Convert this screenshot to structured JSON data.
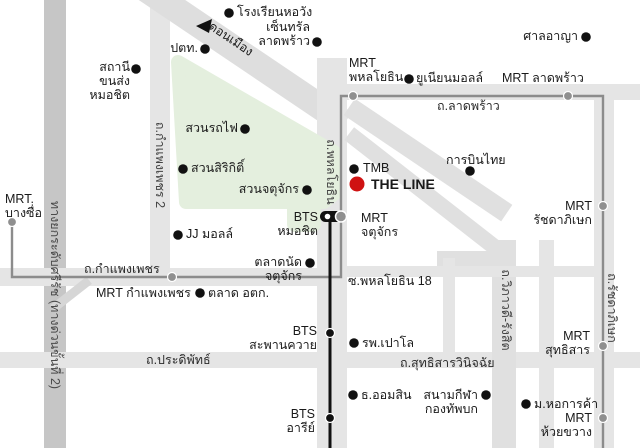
{
  "canvas": {
    "w": 640,
    "h": 448,
    "bg": "#ffffff"
  },
  "palette": {
    "road": "#e5e5e5",
    "road_diag": "#dedede",
    "expressway": "#c6c6c6",
    "park_green": "#e4efde",
    "mrt_line": "#8c8c8c",
    "mrt_station": "#8f8f8f",
    "bts_line": "#111111",
    "poi_dot": "#111111",
    "the_line_red": "#cf1212",
    "text": "#1a1a1a"
  },
  "roads": [
    {
      "name": "road-expressway-sirat",
      "x": 44,
      "y": 0,
      "w": 22,
      "h": 448,
      "rot": 0,
      "color": "#c6c6c6"
    },
    {
      "name": "road-kamphaengphet2-vertical",
      "x": 150,
      "y": 0,
      "w": 20,
      "h": 282,
      "rot": 0,
      "color": "#e5e5e5"
    },
    {
      "name": "road-donmueang-diagonal",
      "x": 125,
      "y": 43,
      "w": 240,
      "h": 26,
      "rot": 34,
      "color": "#dedede"
    },
    {
      "name": "road-phahonyothin-vertical",
      "x": 317,
      "y": 58,
      "w": 30,
      "h": 390,
      "rot": 0,
      "color": "#e5e5e5"
    },
    {
      "name": "road-ladprao-horizontal",
      "x": 332,
      "y": 84,
      "w": 308,
      "h": 16,
      "rot": 0,
      "color": "#e5e5e5"
    },
    {
      "name": "road-kamphaengphet-horizontal",
      "x": 0,
      "y": 268,
      "w": 347,
      "h": 18,
      "rot": 0,
      "color": "#e5e5e5"
    },
    {
      "name": "road-pradipat-sutthisan",
      "x": 0,
      "y": 352,
      "w": 640,
      "h": 16,
      "rot": 0,
      "color": "#e5e5e5"
    },
    {
      "name": "road-vibhavadi-diagonal-a",
      "x": 333,
      "y": 150,
      "w": 190,
      "h": 20,
      "rot": 34,
      "color": "#e0e0e0"
    },
    {
      "name": "road-vibhavadi-diagonal-b",
      "x": 329,
      "y": 184,
      "w": 190,
      "h": 16,
      "rot": 38,
      "color": "#e0e0e0"
    },
    {
      "name": "road-vibhavadi-vertical",
      "x": 492,
      "y": 240,
      "w": 24,
      "h": 208,
      "rot": 0,
      "color": "#e0e0e0"
    },
    {
      "name": "road-vibhavadi-connector",
      "x": 437,
      "y": 251,
      "w": 70,
      "h": 15,
      "rot": 0,
      "color": "#e0e0e0"
    },
    {
      "name": "road-soi-phahonyothin18",
      "x": 347,
      "y": 266,
      "w": 250,
      "h": 11,
      "rot": 0,
      "color": "#e5e5e5"
    },
    {
      "name": "road-minor-vertical-1",
      "x": 443,
      "y": 258,
      "w": 12,
      "h": 102,
      "rot": 0,
      "color": "#e5e5e5"
    },
    {
      "name": "road-minor-vertical-2",
      "x": 539,
      "y": 240,
      "w": 15,
      "h": 208,
      "rot": 0,
      "color": "#e5e5e5"
    },
    {
      "name": "road-ratchadaphisek-vertical",
      "x": 594,
      "y": 84,
      "w": 20,
      "h": 364,
      "rot": 0,
      "color": "#e5e5e5"
    },
    {
      "name": "road-expressway-ramp",
      "x": 48,
      "y": 290,
      "w": 46,
      "h": 9,
      "rot": -38,
      "color": "#d6d6d6"
    }
  ],
  "park": {
    "name": "chatuchak-park-area",
    "outline": "178,62 334,152 334,194 324,202 186,202",
    "notch": {
      "x": 287,
      "y": 200,
      "w": 34,
      "h": 32,
      "rx": 8
    },
    "fill": "#e4efde"
  },
  "transit": {
    "mrt_line": {
      "name": "mrt-blue-line",
      "points": "12,222 12,277 341,277 341,96 603,96 603,448",
      "color": "#8c8c8c",
      "width": 2.4
    },
    "bts_line": {
      "name": "bts-sukhumvit-line",
      "points": "330,220 330,448",
      "color": "#111111",
      "width": 3
    },
    "mrt_stations": [
      {
        "name": "mrt-station-bangsue-dot",
        "x": 12,
        "y": 222
      },
      {
        "name": "mrt-station-kamphaengphet-dot",
        "x": 172,
        "y": 277
      },
      {
        "name": "mrt-station-phahonyothin-dot",
        "x": 353,
        "y": 96
      },
      {
        "name": "mrt-station-ladprao-dot",
        "x": 568,
        "y": 96
      },
      {
        "name": "mrt-station-ratchadaphisek-dot",
        "x": 603,
        "y": 206
      },
      {
        "name": "mrt-station-sutthisan-dot",
        "x": 603,
        "y": 346
      },
      {
        "name": "mrt-station-huaikhwang-dot",
        "x": 603,
        "y": 418
      }
    ],
    "bts_stations": [
      {
        "name": "bts-station-saphankhwai-dot",
        "x": 330,
        "y": 333
      },
      {
        "name": "bts-station-ari-dot",
        "x": 330,
        "y": 418
      }
    ],
    "interchange": {
      "name": "bts-mochit-mrt-chatuchak-interchange",
      "pill": {
        "x": 320,
        "y": 211,
        "w": 22,
        "h": 11,
        "rx": 5.5,
        "color": "#111111"
      },
      "pill_dot": {
        "x": 327.5,
        "y": 216.5,
        "r": 2.8,
        "color": "#ffffff"
      },
      "mrt_circle": {
        "x": 341,
        "y": 216.5,
        "r": 5.5,
        "color": "#8f8f8f"
      }
    }
  },
  "direction_arrow": {
    "name": "to-donmueang-arrow",
    "points": "196,26 212,19 209,33",
    "color": "#111111"
  },
  "poi_dots": [
    {
      "name": "dot-horwang-school",
      "x": 229,
      "y": 13
    },
    {
      "name": "dot-central-ladprao",
      "x": 317,
      "y": 42
    },
    {
      "name": "dot-ptt",
      "x": 205,
      "y": 49
    },
    {
      "name": "dot-mochit-bus-terminal",
      "x": 136,
      "y": 69
    },
    {
      "name": "dot-criminal-court",
      "x": 586,
      "y": 37
    },
    {
      "name": "dot-union-mall",
      "x": 409,
      "y": 79
    },
    {
      "name": "dot-thai-airways",
      "x": 470,
      "y": 171
    },
    {
      "name": "dot-tmb-bank",
      "x": 354,
      "y": 169
    },
    {
      "name": "dot-suan-rotfai",
      "x": 245,
      "y": 129
    },
    {
      "name": "dot-suan-sirikit",
      "x": 183,
      "y": 169
    },
    {
      "name": "dot-suan-chatuchak",
      "x": 307,
      "y": 190
    },
    {
      "name": "dot-jj-mall",
      "x": 178,
      "y": 235
    },
    {
      "name": "dot-chatuchak-market",
      "x": 310,
      "y": 263
    },
    {
      "name": "dot-or-tor-kor-market",
      "x": 200,
      "y": 293
    },
    {
      "name": "dot-paolo-hospital",
      "x": 354,
      "y": 343
    },
    {
      "name": "dot-aomsin-bank",
      "x": 353,
      "y": 395
    },
    {
      "name": "dot-army-stadium",
      "x": 486,
      "y": 395
    },
    {
      "name": "dot-utcc-university",
      "x": 526,
      "y": 404
    }
  ],
  "the_line_marker": {
    "name": "the-line-marker",
    "x": 357,
    "y": 184,
    "r": 7.5,
    "color": "#cf1212"
  },
  "labels": [
    {
      "name": "label-horwang-school",
      "text": "โรงเรียนหอวัง",
      "x": 237,
      "y": 5,
      "w": 110,
      "align": "left"
    },
    {
      "name": "label-central-ladprao",
      "text": "เซ็นทรัล\nลาดพร้าว",
      "x": 250,
      "y": 20,
      "w": 60,
      "align": "right"
    },
    {
      "name": "label-ptt",
      "text": "ปตท.",
      "x": 168,
      "y": 41,
      "w": 30,
      "align": "right"
    },
    {
      "name": "label-donmueang",
      "text": "ดอนเมือง",
      "x": 200,
      "y": 32,
      "w": 62,
      "align": "center",
      "rot": 34
    },
    {
      "name": "label-mochit-bus-terminal",
      "text": "สถานีขนส่ง\nหมอชิต",
      "x": 73,
      "y": 60,
      "w": 57,
      "align": "right"
    },
    {
      "name": "label-criminal-court",
      "text": "ศาลอาญา",
      "x": 518,
      "y": 29,
      "w": 60,
      "align": "right"
    },
    {
      "name": "label-mrt-phahonyothin",
      "text": "MRT\nพหลโยธิน",
      "x": 349,
      "y": 56,
      "w": 70,
      "align": "left"
    },
    {
      "name": "label-union-mall",
      "text": "ยูเนียนมอลล์",
      "x": 416,
      "y": 71,
      "w": 80,
      "align": "left"
    },
    {
      "name": "label-mrt-ladprao",
      "text": "MRT ลาดพร้าว",
      "x": 502,
      "y": 71,
      "w": 90,
      "align": "left"
    },
    {
      "name": "label-road-ladprao",
      "text": "ถ.ลาดพร้าว",
      "x": 437,
      "y": 99,
      "w": 70,
      "align": "left",
      "color": "#2a2a2a"
    },
    {
      "name": "label-thai-airways",
      "text": "การบินไทย",
      "x": 446,
      "y": 153,
      "w": 70,
      "align": "left"
    },
    {
      "name": "label-tmb-bank",
      "text": "TMB",
      "x": 363,
      "y": 161,
      "w": 40,
      "align": "left"
    },
    {
      "name": "label-the-line",
      "text": "THE LINE",
      "x": 371,
      "y": 176,
      "w": 75,
      "align": "left",
      "bold": true,
      "size": 14
    },
    {
      "name": "label-mrt-chatuchak",
      "text": "MRT\nจตุจักร",
      "x": 361,
      "y": 211,
      "w": 55,
      "align": "left"
    },
    {
      "name": "label-bts-mochit",
      "text": "BTS\nหมอชิต",
      "x": 276,
      "y": 210,
      "w": 42,
      "align": "right"
    },
    {
      "name": "label-suan-rotfai",
      "text": "สวนรถไฟ",
      "x": 181,
      "y": 121,
      "w": 57,
      "align": "right"
    },
    {
      "name": "label-suan-sirikit",
      "text": "สวนสิริกิติ์",
      "x": 191,
      "y": 161,
      "w": 70,
      "align": "left"
    },
    {
      "name": "label-suan-chatuchak",
      "text": "สวนจตุจักร",
      "x": 232,
      "y": 182,
      "w": 67,
      "align": "right"
    },
    {
      "name": "label-jj-mall",
      "text": "JJ มอลล์",
      "x": 186,
      "y": 227,
      "w": 60,
      "align": "left"
    },
    {
      "name": "label-chatuchak-market",
      "text": "ตลาดนัดจตุจักร",
      "x": 220,
      "y": 255,
      "w": 82,
      "align": "right"
    },
    {
      "name": "label-mrt-bangsue",
      "text": "MRT.\nบางซื่อ",
      "x": 5,
      "y": 192,
      "w": 48,
      "align": "left"
    },
    {
      "name": "label-road-kamphaengphet",
      "text": "ถ.กำแพงเพชร",
      "x": 84,
      "y": 262,
      "w": 80,
      "align": "left",
      "color": "#2a2a2a"
    },
    {
      "name": "label-mrt-kamphaengphet",
      "text": "MRT กำแพงเพชร",
      "x": 96,
      "y": 286,
      "w": 95,
      "align": "left"
    },
    {
      "name": "label-or-tor-kor-market",
      "text": "ตลาด อตก.",
      "x": 208,
      "y": 286,
      "w": 70,
      "align": "left"
    },
    {
      "name": "label-soi-phahonyothin18",
      "text": "ซ.พหลโยธิน 18",
      "x": 348,
      "y": 274,
      "w": 90,
      "align": "left"
    },
    {
      "name": "label-bts-saphankhwai",
      "text": "BTS\nสะพานควาย",
      "x": 245,
      "y": 324,
      "w": 72,
      "align": "right"
    },
    {
      "name": "label-road-pradipat",
      "text": "ถ.ประดิพัทธ์",
      "x": 146,
      "y": 353,
      "w": 75,
      "align": "left",
      "color": "#2a2a2a"
    },
    {
      "name": "label-road-sutthisan",
      "text": "ถ.สุทธิสารวินิจฉัย",
      "x": 400,
      "y": 356,
      "w": 100,
      "align": "left",
      "color": "#2a2a2a"
    },
    {
      "name": "label-paolo-hospital",
      "text": "รพ.เปาโล",
      "x": 362,
      "y": 336,
      "w": 60,
      "align": "left"
    },
    {
      "name": "label-aomsin-bank",
      "text": "ธ.ออมสิน",
      "x": 361,
      "y": 388,
      "w": 60,
      "align": "left"
    },
    {
      "name": "label-army-stadium",
      "text": "สนามกีฬา\nกองทัพบก",
      "x": 418,
      "y": 388,
      "w": 60,
      "align": "right"
    },
    {
      "name": "label-utcc-university",
      "text": "ม.หอการค้า",
      "x": 534,
      "y": 397,
      "w": 70,
      "align": "left"
    },
    {
      "name": "label-mrt-sutthisan",
      "text": "MRT\nสุทธิสาร",
      "x": 533,
      "y": 329,
      "w": 57,
      "align": "right"
    },
    {
      "name": "label-mrt-huaikhwang",
      "text": "MRT\nห้วยขวาง",
      "x": 530,
      "y": 411,
      "w": 62,
      "align": "right"
    },
    {
      "name": "label-mrt-ratchadaphisek",
      "text": "MRT\nรัชดาภิเษก",
      "x": 520,
      "y": 199,
      "w": 72,
      "align": "right"
    },
    {
      "name": "label-bts-ari",
      "text": "BTS\nอารีย์",
      "x": 273,
      "y": 407,
      "w": 42,
      "align": "right"
    },
    {
      "name": "label-road-vibhavadi",
      "text": "ถ.วิภาวดี-รังสิต",
      "x": 446,
      "y": 303,
      "w": 120,
      "align": "center",
      "rot": 90,
      "color": "#444444"
    },
    {
      "name": "label-road-ratchadaphisek",
      "text": "ถ.รัชดาภิเษก",
      "x": 557,
      "y": 301,
      "w": 110,
      "align": "center",
      "rot": 90,
      "color": "#444444"
    },
    {
      "name": "label-road-phahonyothin",
      "text": "ถ.พหลโยธิน",
      "x": 281,
      "y": 165,
      "w": 100,
      "align": "center",
      "rot": 90,
      "color": "#444444"
    },
    {
      "name": "label-road-kamphaengphet2",
      "text": "ถ.กำแพงเพชร 2",
      "x": 100,
      "y": 158,
      "w": 120,
      "align": "center",
      "rot": 90,
      "color": "#444444"
    },
    {
      "name": "label-expressway-sirat",
      "text": "ทางยกระดับศรีรัช (ทางด่วนขั้นที่ 2)",
      "x": -65,
      "y": 288,
      "w": 240,
      "align": "center",
      "rot": 90,
      "color": "#4a4a4a"
    }
  ]
}
